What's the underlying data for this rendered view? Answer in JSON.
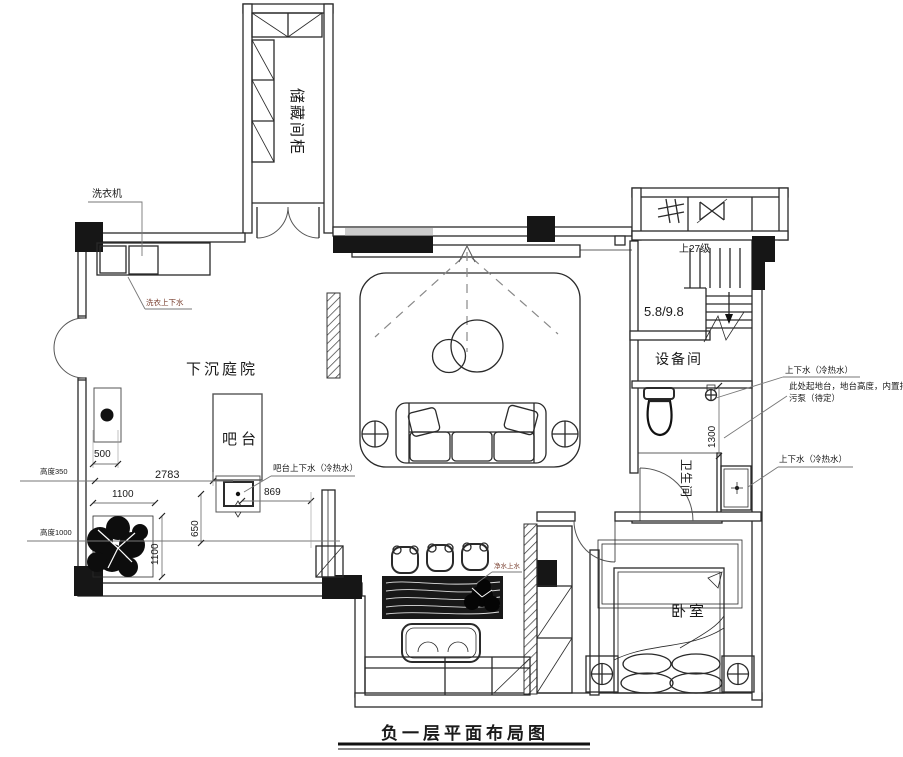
{
  "title": "负一层平面布局图",
  "rooms": {
    "storage": "储藏间柜",
    "courtyard": "下沉庭院",
    "bar": "吧台",
    "equipment": "设备间",
    "bathroom": "卫生间",
    "bedroom": "卧室"
  },
  "annotations": {
    "washing_machine": "洗衣机",
    "laundry_water": "洗衣上下水",
    "bar_water": "吧台上下水（冷热水）",
    "water_hot_cold_1": "上下水（冷热水）",
    "water_hot_cold_2": "上下水（冷热水）",
    "platform_note_line1": "此处起地台，地台高度，内置排",
    "platform_note_line2": "污泵（待定）",
    "purified_water": "净水上水",
    "stairs_up": "上27级",
    "level_mark": "5.8/9.8"
  },
  "dimensions": {
    "d500": "500",
    "d2783": "2783",
    "d1100_h": "1100",
    "d1100_v": "1100",
    "d650": "650",
    "d869": "869",
    "d1300": "1300",
    "height_350": "高度350",
    "height_1000": "高度1000"
  },
  "colors": {
    "line": "#2a2a2a",
    "wall_fill": "#161616",
    "leader": "#777777",
    "plumbing_label": "#7a4030"
  },
  "icons": {
    "top_right_room_1": "grille-hash-symbol",
    "top_right_room_2": "damper-valve-symbol",
    "side_tables": "circle-cross-symbol",
    "nightstand_lamps": "circle-cross-symbol",
    "stairs": "down-arrow"
  }
}
